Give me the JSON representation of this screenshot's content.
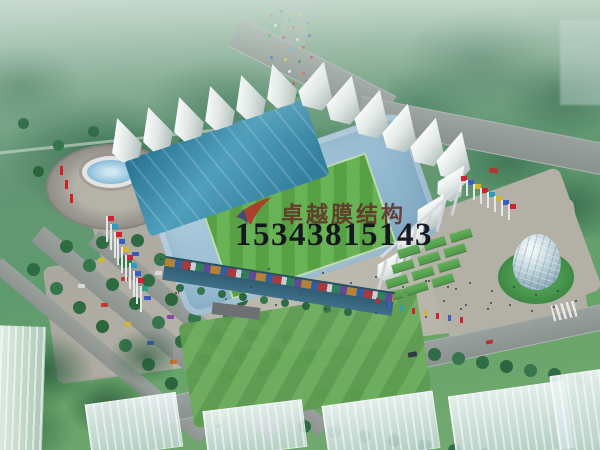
{
  "watermark": {
    "logo": "red-swoosh-logo",
    "company_name": "卓越膜结构",
    "phone_number": "15343815143",
    "company_color": "#613028",
    "phone_color": "#11111b"
  },
  "palette": {
    "haze": "#ceded4",
    "forest_green": "#2f6b45",
    "lawn_green": "#5d9c50",
    "pitch_green_light": "#68b355",
    "pitch_green_dark": "#57a144",
    "stand_roof_teal": "#3f93b2",
    "seats_blue": "#9cc0d6",
    "membrane_white": "#f1f5f3",
    "plaza_gray": "#b5b2a8",
    "road_gray": "#8f9693",
    "fountain_blue": "#8fc0dc",
    "dome_glass": "#c3d6dd"
  }
}
